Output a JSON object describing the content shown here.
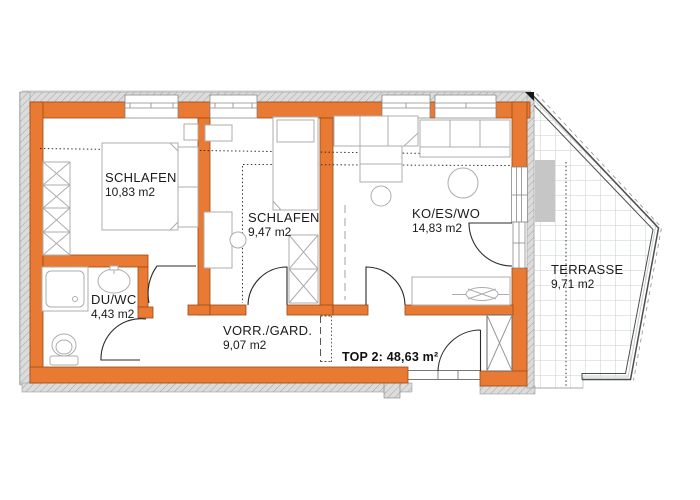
{
  "plan": {
    "unit_label": "TOP 2: 48,63 m²",
    "rooms": [
      {
        "id": "schlafen-1",
        "name": "SCHLAFEN",
        "area": "10,83 m2"
      },
      {
        "id": "schlafen-2",
        "name": "SCHLAFEN",
        "area": "9,47 m2"
      },
      {
        "id": "ko-es-wo",
        "name": "KO/ES/WO",
        "area": "14,83 m2"
      },
      {
        "id": "du-wc",
        "name": "DU/WC",
        "area": "4,43 m2"
      },
      {
        "id": "vorraum",
        "name": "VORR./GARD.",
        "area": "9,07 m2"
      },
      {
        "id": "terrasse",
        "name": "TERRASSE",
        "area": "9,71 m2"
      }
    ],
    "colors": {
      "wall": "#e87a33",
      "wall_outline": "#9c4a12",
      "insulation": "#dcdcdc",
      "furniture_line": "#adadad",
      "door_line": "#2b2b2b",
      "tile_line": "#c9d0ca",
      "mat": "#c6c6c6"
    }
  }
}
